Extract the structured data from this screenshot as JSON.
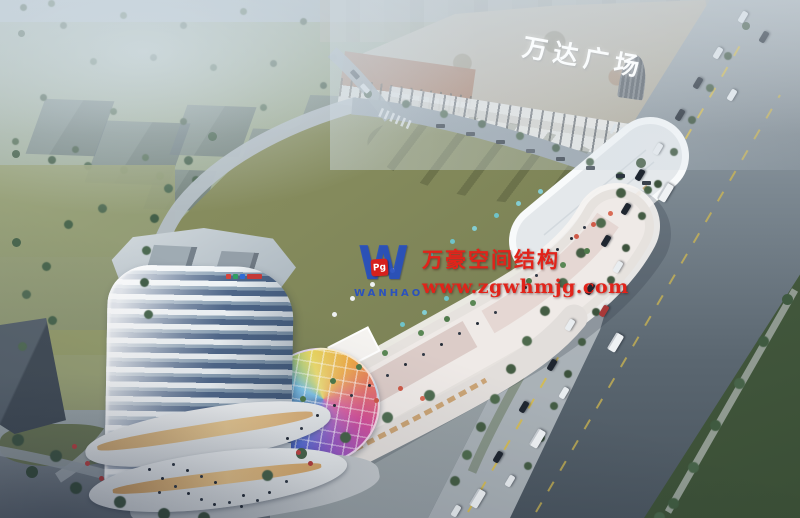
{
  "signs": {
    "mall_sign": "万达广场"
  },
  "watermark": {
    "logo_mark": "W",
    "logo_badge": "Pg",
    "logo_text": "WANHAO",
    "company": "万豪空间结构",
    "website": "www.zgwhmjg.com",
    "text_color": "#e2231a",
    "logo_color": "#2450c4"
  },
  "palette": {
    "sky_haze": "#ccd9e2",
    "lawn_olive": "#85895c",
    "road_gray": "#5f6b76",
    "tower_glass": "#50688a",
    "tower_white": "#eef3f6",
    "strip_roof": "#e6e2de",
    "mall_roof": "#c2bab0",
    "accent_red": "#b8404e",
    "tree_green": "#455d44",
    "pool_blue": "#3f7fae",
    "dome_rainbow": [
      "#e8d44d",
      "#eda83f",
      "#e4726d",
      "#d4509a",
      "#9857c0",
      "#4f68cf",
      "#45a8dd",
      "#9cc46a"
    ]
  }
}
